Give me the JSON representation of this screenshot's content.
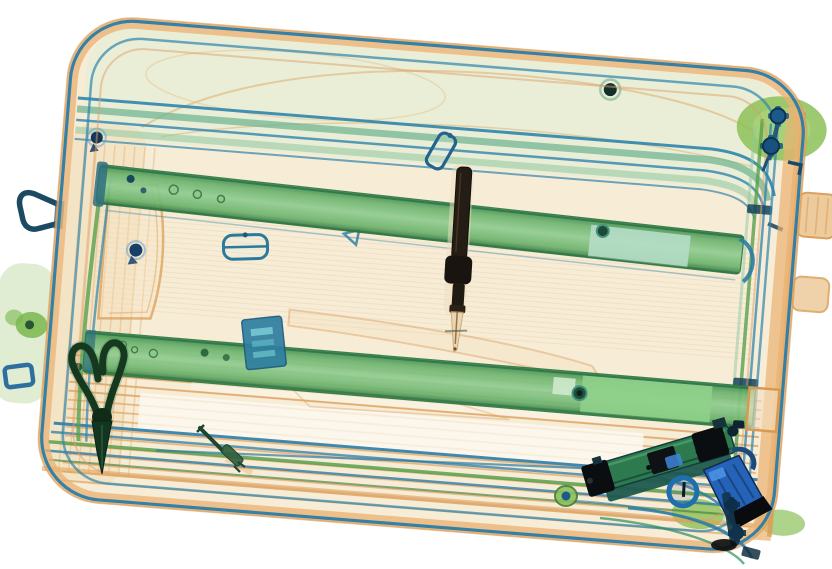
{
  "scene": {
    "type": "xray-baggage-scan",
    "label": "X-ray security scan of a rolling suitcase, slightly rotated clockwise, shown on a white background",
    "visible_text": "none"
  },
  "palette": {
    "background": "#ffffff",
    "shell": "#f7ecd6",
    "lid_tint": "#e8eed7",
    "side_tint": "#f3deb9",
    "stripe_orange": "#dd9e58",
    "wall_orange": "#e9b271",
    "deep_orange": "#d9934a",
    "piping_blue": "#2b7ca6",
    "tube_green": "#57a04d",
    "rail_green": "#7ec07f",
    "rail_green_dark": "#2e7a3e",
    "rail_light": "#b5ddc6",
    "wheel_green": "#8cc158",
    "grommet_blue": "#14365a",
    "tag_teal": "#2e7fa0",
    "gun_slide_green": "#2d7a4f",
    "gun_grip_blue": "#2563b8",
    "trigger_blue": "#1f6fae",
    "dense_black": "#0b0e10",
    "pliers_dark": "#16381f",
    "knife_dark": "#241d15"
  },
  "objects": [
    {
      "name": "suitcase",
      "label": "Suitcase shell (organic/orange) with blue metal piping",
      "location": "full frame"
    },
    {
      "name": "trolley-rail-upper",
      "label": "Upper green trolley rail",
      "location": "upper middle, full width"
    },
    {
      "name": "trolley-rail-lower",
      "label": "Lower green trolley rail",
      "location": "middle, full width"
    },
    {
      "name": "knife",
      "label": "Knife with dense dark handle and faint blade",
      "location": "center, vertical"
    },
    {
      "name": "pliers",
      "label": "Needle-nose pliers, tip down",
      "location": "lower left"
    },
    {
      "name": "driver-tool",
      "label": "Small screwdriver / bit tool",
      "location": "lower left-center, diagonal"
    },
    {
      "name": "handgun",
      "label": "Semi-automatic pistol, muzzle pointing lower-left",
      "location": "lower right"
    },
    {
      "name": "wheel-top-right",
      "label": "Suitcase wheel with metal axle bolts",
      "location": "top right corner"
    },
    {
      "name": "wheel-bottom-right",
      "label": "Suitcase wheel under pistol grip",
      "location": "bottom right corner"
    },
    {
      "name": "luggage-tag",
      "label": "Dense teal tag/box",
      "location": "left of center on lower rail"
    },
    {
      "name": "side-handle",
      "label": "Carry handle loop",
      "location": "left edge"
    },
    {
      "name": "strap-buckle-top",
      "label": "Metal strap buckle outline",
      "location": "top center"
    },
    {
      "name": "strap-buckle-left",
      "label": "Metal slide buckle outline",
      "location": "center left"
    },
    {
      "name": "foot-stud",
      "label": "Green foot stud with metal pin",
      "location": "bottom center"
    }
  ]
}
